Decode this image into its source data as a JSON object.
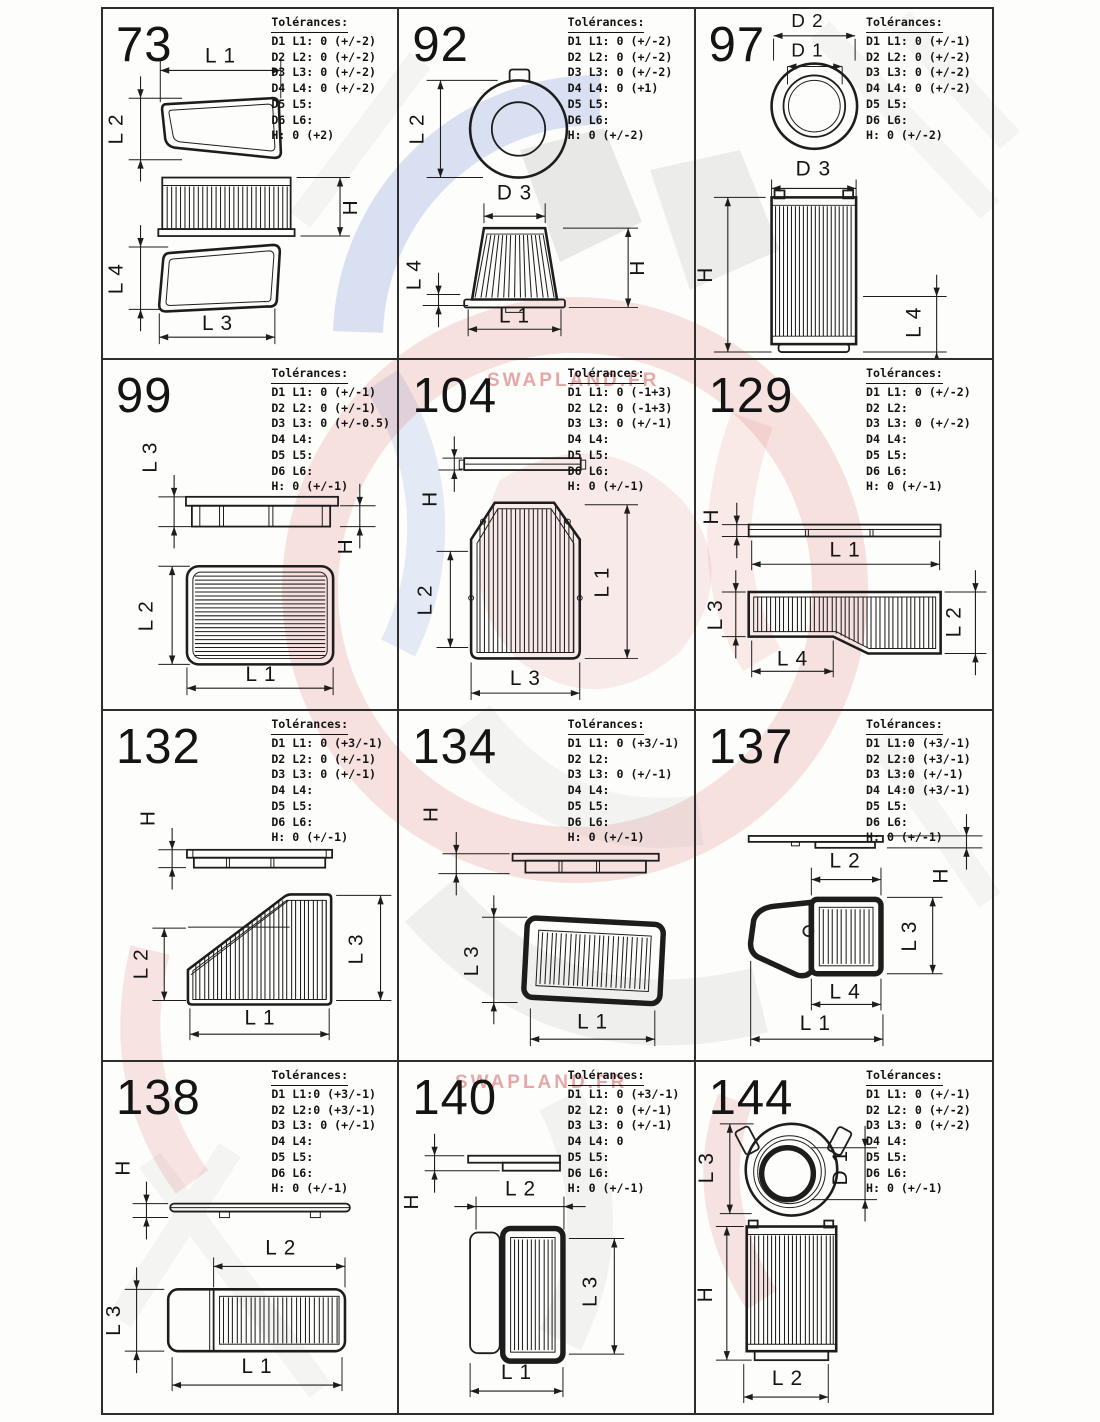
{
  "tolerance_title": "Tolérances:",
  "watermark": {
    "top_text": "SWAPLAND.FR",
    "bottom_text": "SWAPLAND.FR"
  },
  "cells": [
    {
      "number": "73",
      "tol": [
        "D1 L1: 0 (+/-2)",
        "D2 L2: 0 (+/-2)",
        "D3 L3: 0 (+/-2)",
        "D4 L4: 0 (+/-2)",
        "D5 L5:",
        "D6 L6:",
        "H: 0 (+2)"
      ],
      "labels": {
        "l1": "L 1",
        "l2": "L 2",
        "h": "H",
        "l4": "L 4",
        "l3": "L 3"
      }
    },
    {
      "number": "92",
      "tol": [
        "D1 L1: 0 (+/-2)",
        "D2 L2: 0 (+/-2)",
        "D3 L3: 0 (+/-2)",
        "D4 L4: 0 (+1)",
        "D5 L5:",
        "D6 L6:",
        "H: 0 (+/-2)"
      ],
      "labels": {
        "l2": "L 2",
        "d3": "D 3",
        "h": "H",
        "l4": "L 4",
        "l1": "L 1"
      }
    },
    {
      "number": "97",
      "tol": [
        "D1 L1: 0 (+/-1)",
        "D2 L2: 0 (+/-2)",
        "D3 L3: 0 (+/-2)",
        "D4 L4: 0 (+/-2)",
        "D5 L5:",
        "D6 L6:",
        "H: 0 (+/-2)"
      ],
      "labels": {
        "d2": "D 2",
        "d1": "D 1",
        "d3": "D 3",
        "h": "H",
        "l4": "L 4"
      }
    },
    {
      "number": "99",
      "tol": [
        "D1 L1: 0 (+/-1)",
        "D2 L2: 0 (+/-1)",
        "D3 L3: 0 (+/-0.5)",
        "D4 L4:",
        "D5 L5:",
        "D6 L6:",
        "H: 0 (+/-1)"
      ],
      "labels": {
        "l3": "L 3",
        "h": "H",
        "l2": "L 2",
        "l1": "L 1"
      }
    },
    {
      "number": "104",
      "tol": [
        "D1 L1: 0 (-1+3)",
        "D2 L2: 0 (-1+3)",
        "D3 L3: 0 (+/-1)",
        "D4 L4:",
        "D5 L5:",
        "D6 L6:",
        "H: 0 (+/-1)"
      ],
      "labels": {
        "h": "H",
        "l2": "L 2",
        "l1": "L 1",
        "l3": "L 3"
      }
    },
    {
      "number": "129",
      "tol": [
        "D1 L1: 0 (+/-2)",
        "D2 L2:",
        "D3 L3: 0 (+/-2)",
        "D4 L4:",
        "D5 L5:",
        "D6 L6:",
        "H: 0 (+/-1)"
      ],
      "labels": {
        "h": "H",
        "l1": "L 1",
        "l3": "L 3",
        "l2": "L 2",
        "l4": "L 4"
      }
    },
    {
      "number": "132",
      "tol": [
        "D1 L1: 0 (+3/-1)",
        "D2 L2: 0 (+/-1)",
        "D3 L3: 0 (+/-1)",
        "D4 L4:",
        "D5 L5:",
        "D6 L6:",
        "H: 0 (+/-1)"
      ],
      "labels": {
        "h": "H",
        "l2": "L 2",
        "l3": "L 3",
        "l1": "L 1"
      }
    },
    {
      "number": "134",
      "tol": [
        "D1 L1: 0 (+3/-1)",
        "D2 L2:",
        "D3 L3: 0 (+/-1)",
        "D4 L4:",
        "D5 L5:",
        "D6 L6:",
        "H: 0 (+/-1)"
      ],
      "labels": {
        "h": "H",
        "l3": "L 3",
        "l1": "L 1"
      }
    },
    {
      "number": "137",
      "tol": [
        "D1 L1:0 (+3/-1)",
        "D2 L2:0 (+3/-1)",
        "D3 L3:0 (+/-1)",
        "D4 L4:0 (+3/-1)",
        "D5 L5:",
        "D6 L6:",
        "H: 0 (+/-1)"
      ],
      "labels": {
        "h": "H",
        "l2": "L 2",
        "l3": "L 3",
        "l4": "L 4",
        "l1": "L 1"
      }
    },
    {
      "number": "138",
      "tol": [
        "D1 L1:0 (+3/-1)",
        "D2 L2:0 (+3/-1)",
        "D3 L3: 0 (+/-1)",
        "D4 L4:",
        "D5 L5:",
        "D6 L6:",
        "H: 0 (+/-1)"
      ],
      "labels": {
        "h": "H",
        "l2": "L 2",
        "l3": "L 3",
        "l1": "L 1"
      }
    },
    {
      "number": "140",
      "tol": [
        "D1 L1: 0 (+3/-1)",
        "D2 L2: 0 (+/-1)",
        "D3 L3: 0 (+/-1)",
        "D4 L4: 0",
        "D5 L5:",
        "D6 L6:",
        "H: 0 (+/-1)"
      ],
      "labels": {
        "h": "H",
        "l2": "L 2",
        "l3": "L 3",
        "l1": "L 1"
      }
    },
    {
      "number": "144",
      "tol": [
        "D1 L1: 0 (+/-1)",
        "D2 L2: 0 (+/-2)",
        "D3 L3: 0 (+/-2)",
        "D4 L4:",
        "D5 L5:",
        "D6 L6:",
        "H: 0 (+/-1)"
      ],
      "labels": {
        "l3": "L 3",
        "d1": "D 1",
        "h": "H",
        "l2": "L 2"
      }
    }
  ]
}
